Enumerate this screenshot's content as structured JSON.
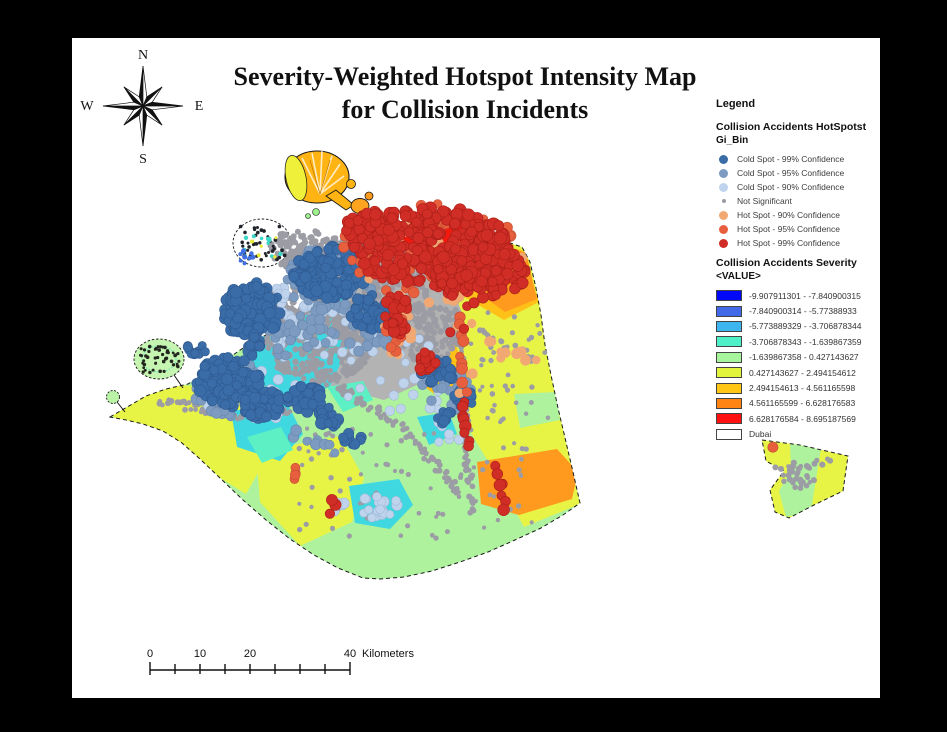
{
  "title": {
    "line1": "Severity-Weighted Hotspot Intensity Map",
    "line2": "for Collision Incidents"
  },
  "compass": {
    "n": "N",
    "s": "S",
    "e": "E",
    "w": "W"
  },
  "legend": {
    "heading": "Legend",
    "section1_title": "Collision Accidents HotSpotst",
    "section1_subtitle": "Gi_Bin",
    "hotspot_classes": [
      {
        "label": "Cold Spot - 99% Confidence",
        "color": "#3a6ca8",
        "size": 9
      },
      {
        "label": "Cold Spot - 95% Confidence",
        "color": "#7d9bc1",
        "size": 9
      },
      {
        "label": "Cold Spot - 90% Confidence",
        "color": "#bfd4ec",
        "size": 9
      },
      {
        "label": "Not Significant",
        "color": "#9c9ca4",
        "size": 4
      },
      {
        "label": "Hot Spot - 90% Confidence",
        "color": "#f2a873",
        "size": 9
      },
      {
        "label": "Hot Spot - 95% Confidence",
        "color": "#e85f3e",
        "size": 9
      },
      {
        "label": "Hot Spot - 99% Confidence",
        "color": "#cf2d26",
        "size": 9
      }
    ],
    "section2_title": "Collision Accidents Severity",
    "section2_subtitle": "<VALUE>",
    "severity_classes": [
      {
        "label": "-9.907911301 - -7.840900315",
        "color": "#0008f8"
      },
      {
        "label": "-7.840900314 - -5.77388933",
        "color": "#4169e8"
      },
      {
        "label": "-5.773889329 - -3.706878344",
        "color": "#3db6f0"
      },
      {
        "label": "-3.706878343 - -1.639867359",
        "color": "#4ef0c8"
      },
      {
        "label": "-1.639867358 - 0.427143627",
        "color": "#a6f59c"
      },
      {
        "label": "0.427143627 - 2.494154612",
        "color": "#e2f53c"
      },
      {
        "label": "2.494154613 - 4.561165598",
        "color": "#ffc714"
      },
      {
        "label": "4.561165599 - 6.628176583",
        "color": "#ff8414"
      },
      {
        "label": "6.628176584 - 8.695187569",
        "color": "#ff1111"
      },
      {
        "label": "Dubai",
        "color": "#ffffff"
      }
    ]
  },
  "scalebar": {
    "tick_interval_km": 5,
    "total_km": 40,
    "px_per_km": 5,
    "labels": [
      {
        "text": "0",
        "km": 0
      },
      {
        "text": "10",
        "km": 10
      },
      {
        "text": "20",
        "km": 20
      },
      {
        "text": "40",
        "km": 40
      }
    ],
    "unit": "Kilometers"
  },
  "map": {
    "region_label": "Dubai",
    "dot_layers": [
      {
        "name": "gray-mass-deira",
        "kind": "b",
        "color": "#9c9ca4",
        "r": 3.1,
        "count": 430,
        "g": [
          360,
          286,
          68,
          54
        ]
      },
      {
        "name": "gray-mass-west",
        "kind": "b",
        "color": "#9c9ca4",
        "r": 3.1,
        "count": 240,
        "g": [
          318,
          346,
          53,
          37
        ]
      },
      {
        "name": "gray-mass-east",
        "kind": "b",
        "color": "#9c9ca4",
        "r": 3.1,
        "count": 150,
        "g": [
          424,
          330,
          41,
          31
        ]
      },
      {
        "name": "gray-mass-north",
        "kind": "b",
        "color": "#9c9ca4",
        "r": 3.1,
        "count": 100,
        "g": [
          301,
          249,
          31,
          21
        ]
      },
      {
        "name": "gray-mass-center",
        "kind": "b",
        "color": "#9c9ca4",
        "r": 3.1,
        "count": 80,
        "g": [
          271,
          306,
          24,
          19
        ]
      },
      {
        "name": "gray-road-w1",
        "kind": "l",
        "color": "#9c9ca4",
        "r": 2.7,
        "count": 40,
        "g": [
          160,
          401,
          241,
          417,
          4
        ]
      },
      {
        "name": "gray-road-w2",
        "kind": "l",
        "color": "#9c9ca4",
        "r": 2.7,
        "count": 32,
        "g": [
          241,
          417,
          313,
          406,
          4
        ]
      },
      {
        "name": "gray-road-sw",
        "kind": "l",
        "color": "#9c9ca4",
        "r": 2.7,
        "count": 55,
        "g": [
          300,
          362,
          403,
          428,
          4
        ]
      },
      {
        "name": "gray-road-s",
        "kind": "l",
        "color": "#9c9ca4",
        "r": 2.7,
        "count": 40,
        "g": [
          403,
          428,
          463,
          497,
          4
        ]
      },
      {
        "name": "gray-road-c",
        "kind": "l",
        "color": "#9c9ca4",
        "r": 2.7,
        "count": 45,
        "g": [
          341,
          301,
          432,
          347,
          4
        ]
      },
      {
        "name": "gray-road-e1",
        "kind": "l",
        "color": "#9c9ca4",
        "r": 2.7,
        "count": 50,
        "g": [
          456,
          293,
          465,
          431,
          3.5
        ]
      },
      {
        "name": "gray-road-e2",
        "kind": "l",
        "color": "#9c9ca4",
        "r": 2.7,
        "count": 28,
        "g": [
          465,
          431,
          472,
          517,
          3.5
        ]
      },
      {
        "name": "gray-road-ne",
        "kind": "l",
        "color": "#9c9ca4",
        "r": 2.7,
        "count": 16,
        "g": [
          478,
          330,
          540,
          360,
          3.5
        ]
      },
      {
        "name": "gray-scatter-south",
        "kind": "s",
        "color": "#9c9ca4",
        "r": 2.4,
        "count": 85,
        "g": [
          298,
          428,
          235,
          112
        ]
      },
      {
        "name": "gray-scatter-east",
        "kind": "s",
        "color": "#9c9ca4",
        "r": 2.4,
        "count": 40,
        "g": [
          468,
          300,
          80,
          140
        ]
      },
      {
        "name": "gray-exclave-cluster",
        "kind": "b",
        "color": "#9c9ca4",
        "r": 2.7,
        "count": 34,
        "g": [
          800,
          477,
          19,
          12
        ]
      },
      {
        "name": "gray-exclave-road",
        "kind": "l",
        "color": "#9c9ca4",
        "r": 2.7,
        "count": 12,
        "g": [
          774,
          468,
          834,
          461,
          3
        ]
      },
      {
        "name": "world-specks-dark",
        "kind": "s",
        "color": "#20242a",
        "r": 1.7,
        "count": 40,
        "g": [
          240,
          226,
          45,
          35
        ]
      },
      {
        "name": "world-specks-cyan",
        "kind": "s",
        "color": "#3bd8c8",
        "r": 2.0,
        "count": 11,
        "g": [
          243,
          229,
          40,
          29
        ]
      },
      {
        "name": "world-specks-blue",
        "kind": "b",
        "color": "#3f6fe0",
        "r": 2.2,
        "count": 10,
        "g": [
          246,
          257,
          8,
          7
        ]
      },
      {
        "name": "world-specks-yellow",
        "kind": "s",
        "color": "#e8e838",
        "r": 1.8,
        "count": 6,
        "g": [
          250,
          236,
          28,
          22
        ]
      },
      {
        "name": "palm-jebel-ali-specks",
        "kind": "s",
        "color": "#23261f",
        "r": 1.6,
        "count": 46,
        "g": [
          140,
          346,
          40,
          27
        ]
      },
      {
        "name": "coldspot90-fringe-n",
        "kind": "b",
        "color": "#bfd4ec",
        "stroke": "#9fb8d8",
        "r": 4.8,
        "count": 42,
        "g": [
          302,
          320,
          57,
          46
        ]
      },
      {
        "name": "coldspot90-fringe-sw",
        "kind": "b",
        "color": "#bfd4ec",
        "stroke": "#9fb8d8",
        "r": 4.8,
        "count": 30,
        "g": [
          251,
          398,
          51,
          35
        ]
      },
      {
        "name": "coldspot90-fringe-e",
        "kind": "b",
        "color": "#bfd4ec",
        "stroke": "#9fb8d8",
        "r": 4.6,
        "count": 26,
        "g": [
          397,
          378,
          56,
          48
        ]
      },
      {
        "name": "coldspot90-cluster-s",
        "kind": "b",
        "color": "#bfd4ec",
        "stroke": "#9fb8d8",
        "r": 4.8,
        "count": 18,
        "g": [
          379,
          506,
          21,
          15
        ]
      },
      {
        "name": "coldspot90-pair",
        "kind": "b",
        "color": "#bfd4ec",
        "stroke": "#9fb8d8",
        "r": 4.6,
        "count": 4,
        "g": [
          340,
          507,
          8,
          6
        ]
      },
      {
        "name": "coldspot90-e2",
        "kind": "s",
        "color": "#bfd4ec",
        "stroke": "#9fb8d8",
        "r": 4.4,
        "count": 7,
        "g": [
          418,
          408,
          48,
          36
        ]
      },
      {
        "name": "coldspot95-n",
        "kind": "b",
        "color": "#7d9bc1",
        "stroke": "#6888ad",
        "r": 5.0,
        "count": 55,
        "g": [
          331,
          278,
          46,
          33
        ]
      },
      {
        "name": "coldspot95-sw",
        "kind": "b",
        "color": "#7d9bc1",
        "stroke": "#6888ad",
        "r": 5.0,
        "count": 46,
        "g": [
          238,
          391,
          43,
          31
        ]
      },
      {
        "name": "coldspot95-c",
        "kind": "b",
        "color": "#7d9bc1",
        "stroke": "#6888ad",
        "r": 5.0,
        "count": 32,
        "g": [
          300,
          331,
          35,
          29
        ]
      },
      {
        "name": "coldspot95-e",
        "kind": "b",
        "color": "#7d9bc1",
        "stroke": "#6888ad",
        "r": 5.0,
        "count": 26,
        "g": [
          373,
          331,
          28,
          24
        ]
      },
      {
        "name": "coldspot95-se",
        "kind": "b",
        "color": "#7d9bc1",
        "stroke": "#6888ad",
        "r": 5.0,
        "count": 16,
        "g": [
          446,
          391,
          25,
          20
        ]
      },
      {
        "name": "coldspot95-road",
        "kind": "l",
        "color": "#7d9bc1",
        "stroke": "#6888ad",
        "r": 4.8,
        "count": 8,
        "g": [
          290,
          431,
          342,
          451,
          5
        ]
      },
      {
        "name": "coldspot99-palm-jumeirah",
        "kind": "b",
        "color": "#3a6ca8",
        "stroke": "#2f5a8f",
        "r": 5.3,
        "count": 125,
        "g": [
          252,
          310,
          29,
          29
        ]
      },
      {
        "name": "coldspot99-palm-stem",
        "kind": "b",
        "color": "#3a6ca8",
        "stroke": "#2f5a8f",
        "r": 5.0,
        "count": 13,
        "g": [
          252,
          344,
          8,
          12
        ]
      },
      {
        "name": "coldspot99-n",
        "kind": "b",
        "color": "#3a6ca8",
        "stroke": "#2f5a8f",
        "r": 5.3,
        "count": 135,
        "g": [
          330,
          272,
          37,
          26
        ]
      },
      {
        "name": "coldspot99-ne",
        "kind": "b",
        "color": "#3a6ca8",
        "stroke": "#2f5a8f",
        "r": 5.2,
        "count": 48,
        "g": [
          371,
          312,
          20,
          17
        ]
      },
      {
        "name": "coldspot99-sw1",
        "kind": "b",
        "color": "#3a6ca8",
        "stroke": "#2f5a8f",
        "r": 5.3,
        "count": 115,
        "g": [
          228,
          382,
          32,
          25
        ]
      },
      {
        "name": "coldspot99-sw2",
        "kind": "b",
        "color": "#3a6ca8",
        "stroke": "#2f5a8f",
        "r": 5.2,
        "count": 50,
        "g": [
          262,
          404,
          21,
          15
        ]
      },
      {
        "name": "coldspot99-sw3",
        "kind": "b",
        "color": "#3a6ca8",
        "stroke": "#2f5a8f",
        "r": 5.2,
        "count": 42,
        "g": [
          305,
          398,
          19,
          14
        ]
      },
      {
        "name": "coldspot99-sw4",
        "kind": "b",
        "color": "#3a6ca8",
        "stroke": "#2f5a8f",
        "r": 5.0,
        "count": 22,
        "g": [
          330,
          417,
          13,
          10
        ]
      },
      {
        "name": "coldspot99-se1",
        "kind": "b",
        "color": "#3a6ca8",
        "stroke": "#2f5a8f",
        "r": 5.2,
        "count": 30,
        "g": [
          438,
          372,
          17,
          13
        ]
      },
      {
        "name": "coldspot99-se2",
        "kind": "b",
        "color": "#3a6ca8",
        "stroke": "#2f5a8f",
        "r": 5.0,
        "count": 15,
        "g": [
          464,
          398,
          11,
          9
        ]
      },
      {
        "name": "coldspot99-se3",
        "kind": "b",
        "color": "#3a6ca8",
        "stroke": "#2f5a8f",
        "r": 4.8,
        "count": 9,
        "g": [
          446,
          417,
          9,
          7
        ]
      },
      {
        "name": "coldspot99-dock",
        "kind": "b",
        "color": "#3a6ca8",
        "stroke": "#2f5a8f",
        "r": 4.6,
        "count": 11,
        "g": [
          197,
          349,
          11,
          6
        ]
      },
      {
        "name": "coldspot99-s",
        "kind": "b",
        "color": "#3a6ca8",
        "stroke": "#2f5a8f",
        "r": 4.8,
        "count": 9,
        "g": [
          352,
          440,
          10,
          7
        ]
      },
      {
        "name": "hotspot90-fringe",
        "kind": "b",
        "color": "#f2a873",
        "r": 5.0,
        "count": 38,
        "g": [
          430,
          251,
          97,
          52
        ]
      },
      {
        "name": "hotspot90-streak",
        "kind": "b",
        "color": "#f2a873",
        "r": 4.8,
        "count": 9,
        "g": [
          398,
          333,
          15,
          25
        ]
      },
      {
        "name": "hotspot90-road",
        "kind": "l",
        "color": "#f2a873",
        "r": 4.8,
        "count": 7,
        "g": [
          492,
          345,
          538,
          362,
          4
        ]
      },
      {
        "name": "hotspot90-scatter",
        "kind": "s",
        "color": "#f2a873",
        "r": 4.8,
        "count": 8,
        "g": [
          445,
          300,
          65,
          130
        ]
      },
      {
        "name": "hotspot95-ring",
        "kind": "b",
        "color": "#e85f3e",
        "stroke": "#c44f33",
        "r": 5.1,
        "count": 55,
        "g": [
          430,
          250,
          90,
          47
        ]
      },
      {
        "name": "hotspot95-streak",
        "kind": "b",
        "color": "#e85f3e",
        "stroke": "#c44f33",
        "r": 5.0,
        "count": 12,
        "g": [
          398,
          331,
          13,
          23
        ]
      },
      {
        "name": "hotspot95-road",
        "kind": "l",
        "color": "#e85f3e",
        "stroke": "#c44f33",
        "r": 5.0,
        "count": 9,
        "g": [
          459,
          312,
          465,
          394,
          3
        ]
      },
      {
        "name": "hotspot95-exclave",
        "kind": "b",
        "color": "#e85f3e",
        "stroke": "#c44f33",
        "r": 5.0,
        "count": 1,
        "g": [
          772,
          447,
          1,
          1
        ]
      },
      {
        "name": "hotspot95-s",
        "kind": "b",
        "color": "#e85f3e",
        "stroke": "#c44f33",
        "r": 4.8,
        "count": 4,
        "g": [
          297,
          474,
          5,
          8
        ]
      },
      {
        "name": "hotspot99-main",
        "kind": "b",
        "color": "#cf2d26",
        "stroke": "#aa1f18",
        "r": 5.5,
        "count": 290,
        "g": [
          432,
          247,
          80,
          40
        ]
      },
      {
        "name": "hotspot99-east",
        "kind": "b",
        "color": "#cf2d26",
        "stroke": "#aa1f18",
        "r": 5.4,
        "count": 110,
        "g": [
          478,
          272,
          50,
          26
        ]
      },
      {
        "name": "hotspot99-west",
        "kind": "b",
        "color": "#cf2d26",
        "stroke": "#aa1f18",
        "r": 5.3,
        "count": 40,
        "g": [
          370,
          228,
          26,
          19
        ]
      },
      {
        "name": "hotspot99-streak",
        "kind": "b",
        "color": "#cf2d26",
        "stroke": "#aa1f18",
        "r": 5.3,
        "count": 26,
        "g": [
          396,
          316,
          12,
          25
        ]
      },
      {
        "name": "hotspot99-blob-c",
        "kind": "b",
        "color": "#cf2d26",
        "stroke": "#aa1f18",
        "r": 5.3,
        "count": 14,
        "g": [
          425,
          362,
          12,
          11
        ]
      },
      {
        "name": "hotspot99-road1",
        "kind": "l",
        "color": "#cf2d26",
        "stroke": "#aa1f18",
        "r": 5.2,
        "count": 8,
        "g": [
          462,
          400,
          468,
          450,
          2.5
        ]
      },
      {
        "name": "hotspot99-road2",
        "kind": "l",
        "color": "#cf2d26",
        "stroke": "#aa1f18",
        "r": 5.2,
        "count": 7,
        "g": [
          497,
          466,
          506,
          511,
          2.5
        ]
      },
      {
        "name": "hotspot99-s",
        "kind": "b",
        "color": "#cf2d26",
        "stroke": "#aa1f18",
        "r": 5.0,
        "count": 4,
        "g": [
          331,
          505,
          5,
          9
        ]
      },
      {
        "name": "hotspot99-scatter",
        "kind": "s",
        "color": "#cf2d26",
        "stroke": "#aa1f18",
        "r": 5.0,
        "count": 5,
        "g": [
          432,
          285,
          55,
          70
        ]
      }
    ]
  }
}
